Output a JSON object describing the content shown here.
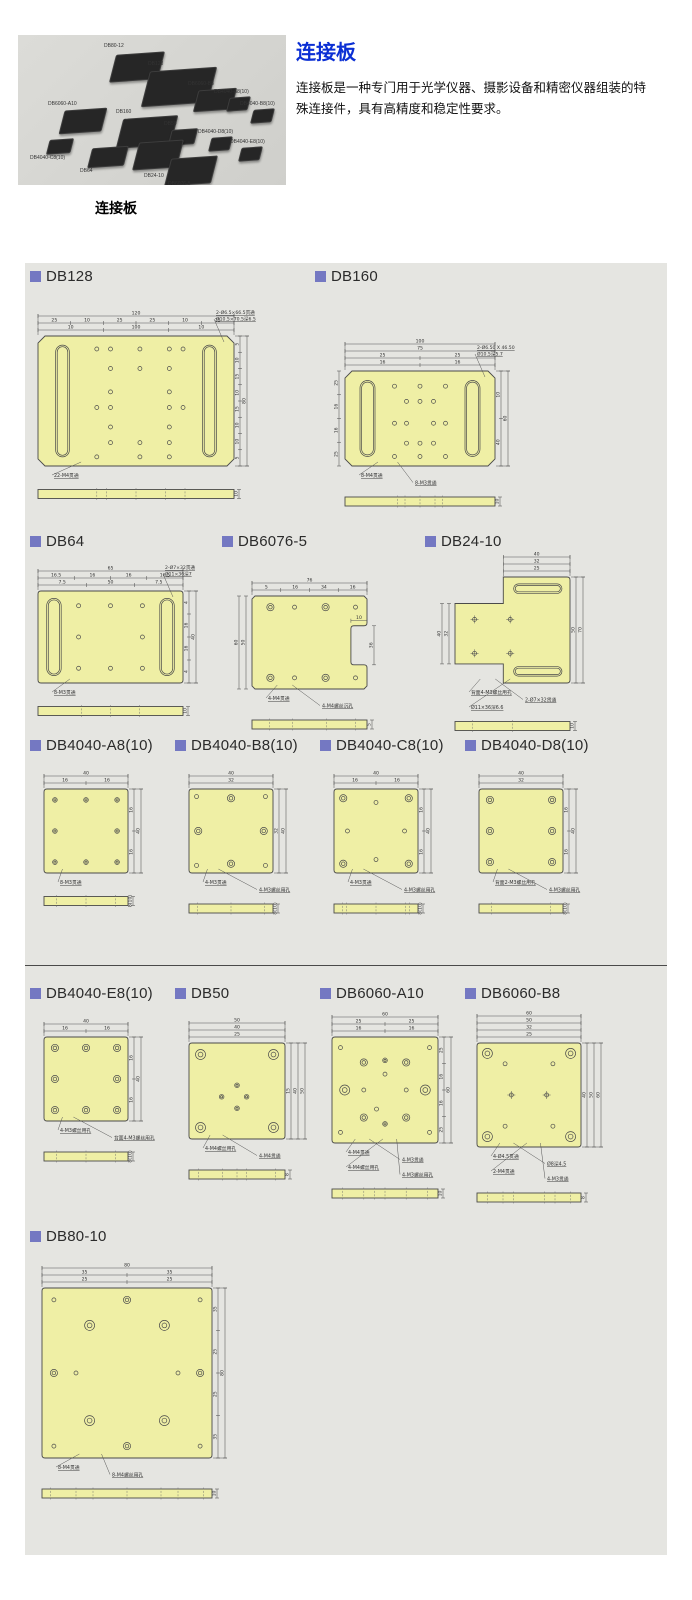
{
  "header": {
    "title": "连接板",
    "description": "连接板是一种专门用于光学仪器、摄影设备和精密仪器组装的特殊连接件，具有高精度和稳定性要求。",
    "photo_caption": "连接板",
    "photo_labels": [
      "DB80-12",
      "DB128",
      "DB6060-B8",
      "DB6060-A10",
      "DB4040-A8(10)",
      "DB4040-B8(10)",
      "DB160",
      "DB50",
      "DB4040-D8(10)",
      "DB4040-E8(10)",
      "DB4040-C8(10)",
      "DB64",
      "DB24-10",
      "DB6076-5"
    ]
  },
  "colors": {
    "accent_square": "#7478c2",
    "title_blue": "#0b2fd4",
    "panel_bg": "#e5e5e1",
    "plate_fill": "#efefa5"
  },
  "sections": [
    {
      "id": "db128",
      "name": "DB128",
      "top_dims": [
        [
          "120"
        ],
        [
          "25",
          "10",
          "25",
          "25",
          "10",
          "25"
        ],
        [
          "10",
          "100",
          "10"
        ]
      ],
      "right_dims": [
        [
          "80"
        ],
        [
          "5",
          "10",
          "15",
          "10",
          "15",
          "10",
          "10",
          "5"
        ]
      ],
      "left_dims": [],
      "corner_notes": [
        "2-Ø6.5×66.5贯通",
        "Ø10.5×70.5深6.5"
      ],
      "notes": [
        "22-M4贯通"
      ],
      "side_height": "10"
    },
    {
      "id": "db160",
      "name": "DB160",
      "top_dims": [
        [
          "100"
        ],
        [
          "75"
        ],
        [
          "25",
          "25"
        ],
        [
          "16",
          "16"
        ]
      ],
      "right_dims": [
        [
          "60"
        ],
        [
          "10",
          "40"
        ]
      ],
      "left_dims": [
        [
          "25",
          "16",
          "16",
          "25"
        ]
      ],
      "corner_notes": [
        "2-Ø6.50 X 46.50",
        "Ø10.5深5.7"
      ],
      "notes": [
        "8-M4贯通",
        "8-M3贯通"
      ],
      "side_height": "10"
    },
    {
      "id": "db64",
      "name": "DB64",
      "top_dims": [
        [
          "65"
        ],
        [
          "16.5",
          "16",
          "16",
          "16.5"
        ],
        [
          "7.5",
          "50",
          "7.5"
        ]
      ],
      "right_dims": [
        [
          "40"
        ],
        [
          "4",
          "16",
          "16",
          "4"
        ]
      ],
      "left_dims": [],
      "corner_notes": [
        "2-Ø7×32贯通",
        "Ø11×36深7"
      ],
      "notes": [
        "8-M3贯通"
      ],
      "side_height": "10"
    },
    {
      "id": "db6076",
      "name": "DB6076-5",
      "top_dims": [
        [
          "76"
        ],
        [
          "5",
          "16",
          "34",
          "16"
        ]
      ],
      "right_dims": [],
      "left_dims": [
        [
          "60"
        ],
        [
          "50"
        ]
      ],
      "cutout_dims": [
        "10",
        "36"
      ],
      "corner_notes": [],
      "notes": [
        "4-M4贯通",
        "4-M4螺丝沉孔"
      ],
      "side_height": "5"
    },
    {
      "id": "db24",
      "name": "DB24-10",
      "top_dims": [
        [
          "40"
        ],
        [
          "32"
        ],
        [
          "25"
        ]
      ],
      "right_dims": [
        [
          "70"
        ],
        [
          "50"
        ]
      ],
      "left_dims": [
        [
          "40"
        ],
        [
          "32"
        ]
      ],
      "corner_notes": [],
      "notes": [
        "背面4-M3螺丝用孔",
        "2-Ø7×32贯通",
        "Ø11×36深6.6"
      ],
      "side_height": "10"
    },
    {
      "id": "db4040a",
      "name": "DB4040-A8(10)",
      "top_dims": [
        [
          "40"
        ],
        [
          "16",
          "16"
        ]
      ],
      "right_dims": [
        [
          "40"
        ],
        [
          "16",
          "16"
        ]
      ],
      "left_dims": [],
      "corner_notes": [],
      "notes": [
        "8-M3贯通"
      ],
      "side_height": "8(10)"
    },
    {
      "id": "db4040b",
      "name": "DB4040-B8(10)",
      "top_dims": [
        [
          "40"
        ],
        [
          "32"
        ]
      ],
      "right_dims": [
        [
          "40"
        ],
        [
          "32"
        ]
      ],
      "left_dims": [],
      "corner_notes": [],
      "notes": [
        "4-M3贯通",
        "4-M3螺丝用孔"
      ],
      "side_height": "8(10)"
    },
    {
      "id": "db4040c",
      "name": "DB4040-C8(10)",
      "top_dims": [
        [
          "40"
        ],
        [
          "16",
          "16"
        ]
      ],
      "right_dims": [
        [
          "40"
        ],
        [
          "16",
          "16"
        ]
      ],
      "left_dims": [],
      "corner_notes": [],
      "notes": [
        "4-M3贯通",
        "4-M3螺丝用孔"
      ],
      "side_height": "8(10)"
    },
    {
      "id": "db4040d",
      "name": "DB4040-D8(10)",
      "top_dims": [
        [
          "40"
        ],
        [
          "32"
        ]
      ],
      "right_dims": [
        [
          "40"
        ],
        [
          "16",
          "16"
        ]
      ],
      "left_dims": [],
      "corner_notes": [],
      "notes": [
        "背面2-M3螺丝用孔",
        "4-M3螺丝用孔"
      ],
      "side_height": "8(10)"
    },
    {
      "id": "db4040e",
      "name": "DB4040-E8(10)",
      "top_dims": [
        [
          "40"
        ],
        [
          "16",
          "16"
        ]
      ],
      "right_dims": [
        [
          "40"
        ],
        [
          "16",
          "16"
        ]
      ],
      "left_dims": [],
      "corner_notes": [],
      "notes": [
        "4-M3螺丝用孔",
        "背面4-M3螺丝用孔"
      ],
      "side_height": "8(10)"
    },
    {
      "id": "db50",
      "name": "DB50",
      "top_dims": [
        [
          "50"
        ],
        [
          "40"
        ],
        [
          "25"
        ]
      ],
      "right_dims": [
        [
          "50"
        ],
        [
          "40"
        ],
        [
          "15"
        ]
      ],
      "left_dims": [],
      "corner_notes": [],
      "notes": [
        "4-M4螺丝用孔",
        "4-M4贯通"
      ],
      "side_height": "8"
    },
    {
      "id": "db6060a",
      "name": "DB6060-A10",
      "top_dims": [
        [
          "60"
        ],
        [
          "25",
          "25"
        ],
        [
          "16",
          "16"
        ]
      ],
      "right_dims": [
        [
          "60"
        ],
        [
          "25",
          "16",
          "16",
          "25"
        ]
      ],
      "left_dims": [],
      "corner_notes": [],
      "notes": [
        "4-M4贯通",
        "4-M3贯通",
        "4-M4螺丝用孔",
        "4-M3螺丝用孔"
      ],
      "side_height": "10"
    },
    {
      "id": "db6060b",
      "name": "DB6060-B8",
      "top_dims": [
        [
          "60"
        ],
        [
          "50"
        ],
        [
          "32"
        ],
        [
          "25"
        ]
      ],
      "right_dims": [
        [
          "60"
        ],
        [
          "50"
        ],
        [
          "40"
        ]
      ],
      "left_dims": [],
      "corner_notes": [],
      "notes": [
        "4-Ø4.5贯通",
        "Ø8深4.5",
        "2-M4贯通",
        "4-M3贯通"
      ],
      "side_height": "8"
    },
    {
      "id": "db80",
      "name": "DB80-10",
      "top_dims": [
        [
          "80"
        ],
        [
          "35",
          "35"
        ],
        [
          "25",
          "25"
        ]
      ],
      "right_dims": [
        [
          "80"
        ],
        [
          "35",
          "25",
          "25",
          "35"
        ]
      ],
      "left_dims": [],
      "corner_notes": [],
      "notes": [
        "8-M4贯通",
        "8-M4螺丝用孔"
      ],
      "side_height": "10"
    }
  ]
}
